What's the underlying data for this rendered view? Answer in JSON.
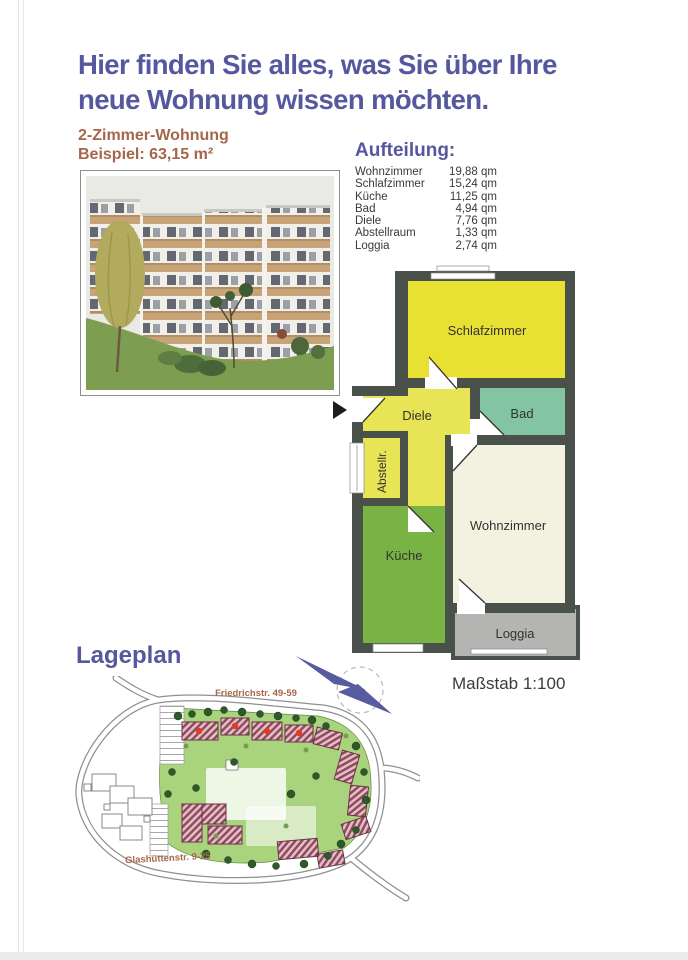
{
  "header": {
    "title_line1": "Hier finden Sie alles, was Sie über Ihre",
    "title_line2": "neue Wohnung wissen möchten."
  },
  "apartment": {
    "type": "2-Zimmer-Wohnung",
    "example": "Beispiel: 63,15 m²"
  },
  "aufteilung": {
    "heading": "Aufteilung:",
    "rows": [
      {
        "room": "Wohnzimmer",
        "area": "19,88 qm"
      },
      {
        "room": "Schlafzimmer",
        "area": "15,24 qm"
      },
      {
        "room": "Küche",
        "area": "11,25 qm"
      },
      {
        "room": "Bad",
        "area": "4,94 qm"
      },
      {
        "room": "Diele",
        "area": "7,76 qm"
      },
      {
        "room": "Abstellraum",
        "area": "1,33 qm"
      },
      {
        "room": "Loggia",
        "area": "2,74 qm"
      }
    ]
  },
  "floorplan": {
    "labels": {
      "schlafzimmer": "Schlafzimmer",
      "diele": "Diele",
      "bad": "Bad",
      "abstell": "Abstellr.",
      "kueche": "Küche",
      "wohnzimmer": "Wohnzimmer",
      "loggia": "Loggia"
    },
    "scale": "Maßstab 1:100"
  },
  "lageplan": {
    "heading": "Lageplan",
    "street_top": "Friedrichstr. 49-59",
    "street_bottom": "Glashüttenstr. 9-25"
  },
  "colors": {
    "accent_purple": "#55589e",
    "accent_brown": "#a5664a",
    "wall": "#49514a",
    "schlafzimmer": "#e8e132",
    "diele": "#e7e455",
    "bad": "#83c4a2",
    "kueche": "#79b343",
    "wohnzimmer": "#f3f1df",
    "loggia": "#b4b4b2",
    "siteplan_green": "#aad37e",
    "marker_red": "#e33a26"
  }
}
